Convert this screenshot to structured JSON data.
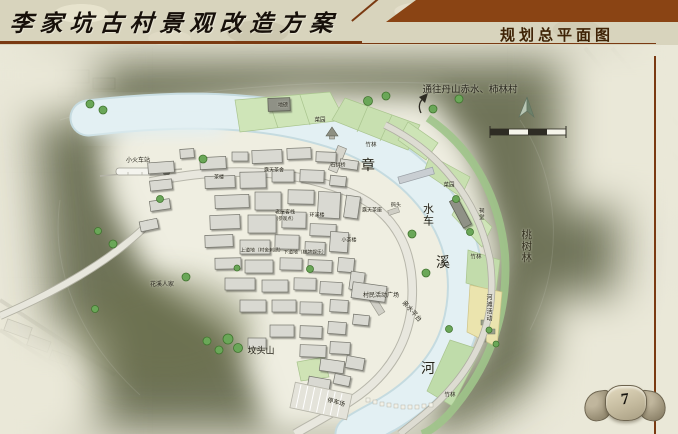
{
  "slide": {
    "title": "李家坑古村景观改造方案",
    "section_title": "规划总平面图",
    "page_number": "7"
  },
  "map": {
    "direction_note": "通往丹山赤水、柿林村",
    "river_name": "章溪河",
    "icons": {
      "north_arrow": "north-arrow",
      "scale_bar": "scale-bar",
      "direction_arrow": "up-arrow"
    },
    "colors": {
      "header_brown": "#8a4414",
      "rule_brown": "#7a3a12",
      "mountain_olive": "#4d5334",
      "river_blue": "#e3f0f3",
      "bank_green": "#cde4b6",
      "beach_yellow": "#ebe4ae",
      "paper": "#e9e7d8"
    },
    "labels": [
      {
        "t": "通往丹山赤水、柿林村",
        "x": 470,
        "y": 91,
        "s": 9.5
      },
      {
        "t": "章",
        "x": 368,
        "y": 167,
        "s": 14
      },
      {
        "t": "水车",
        "x": 427,
        "y": 215,
        "s": 11,
        "v": true
      },
      {
        "t": "溪",
        "x": 443,
        "y": 264,
        "s": 14
      },
      {
        "t": "河",
        "x": 428,
        "y": 370,
        "s": 14
      },
      {
        "t": "桃树林",
        "x": 525,
        "y": 246,
        "s": 10.5,
        "v": true,
        "c": "#33301f"
      },
      {
        "t": "坟头山",
        "x": 261,
        "y": 351,
        "s": 9
      },
      {
        "t": "小火车站",
        "x": 138,
        "y": 161,
        "s": 6
      },
      {
        "t": "花溪人家",
        "x": 162,
        "y": 285,
        "s": 6
      },
      {
        "t": "竹林",
        "x": 371,
        "y": 146,
        "s": 5.5
      },
      {
        "t": "竹林",
        "x": 476,
        "y": 258,
        "s": 5.5
      },
      {
        "t": "竹林",
        "x": 450,
        "y": 396,
        "s": 5.5
      },
      {
        "t": "菜园",
        "x": 320,
        "y": 121,
        "s": 5.5
      },
      {
        "t": "菜园",
        "x": 449,
        "y": 186,
        "s": 5.5
      },
      {
        "t": "地磅",
        "x": 283,
        "y": 106,
        "s": 5
      },
      {
        "t": "茶楼",
        "x": 219,
        "y": 178,
        "s": 5
      },
      {
        "t": "露天茶舍",
        "x": 274,
        "y": 171,
        "s": 5
      },
      {
        "t": "石拱桥",
        "x": 338,
        "y": 166,
        "s": 5
      },
      {
        "t": "码头",
        "x": 396,
        "y": 206,
        "s": 5
      },
      {
        "t": "露天茶座",
        "x": 372,
        "y": 211,
        "s": 5
      },
      {
        "t": "老屋客栈",
        "x": 285,
        "y": 213,
        "s": 5
      },
      {
        "t": "（参观点）",
        "x": 285,
        "y": 219,
        "s": 4.5
      },
      {
        "t": "环溪楼",
        "x": 317,
        "y": 216,
        "s": 5
      },
      {
        "t": "上道地（村舍刺绣）",
        "x": 262,
        "y": 252,
        "s": 4.8
      },
      {
        "t": "下道地（棋牌娱乐）",
        "x": 305,
        "y": 254,
        "s": 4.8
      },
      {
        "t": "小茶楼",
        "x": 349,
        "y": 241,
        "s": 5
      },
      {
        "t": "祠堂",
        "x": 480,
        "y": 214,
        "s": 5.5,
        "v": true
      },
      {
        "t": "村民活动广场",
        "x": 381,
        "y": 296,
        "s": 6
      },
      {
        "t": "亲水平台",
        "x": 411,
        "y": 312,
        "s": 6.5,
        "r": 48
      },
      {
        "t": "河滩活动",
        "x": 488,
        "y": 308,
        "s": 6,
        "v": true
      },
      {
        "t": "停车场",
        "x": 336,
        "y": 403,
        "s": 6,
        "r": 15
      }
    ]
  }
}
